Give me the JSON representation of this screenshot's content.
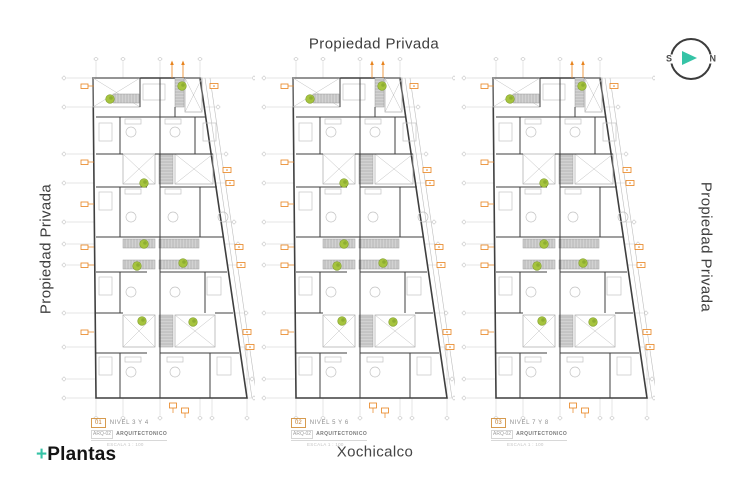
{
  "labels": {
    "top": "Propiedad Privada",
    "left": "Propiedad Privada",
    "right": "Propiedad Privada",
    "bottom_center": "Xochicalco",
    "logo_plus": "+",
    "logo_text": "Plantas"
  },
  "compass": {
    "west_label": "S",
    "east_label": "N"
  },
  "plans": [
    {
      "number": "01",
      "level_label": "NIVEL 3 Y 4",
      "sheet_code": "ARQ-02",
      "sheet_label": "ARQUITECTONICO",
      "scale_label": "ESCALA 1 : 100"
    },
    {
      "number": "02",
      "level_label": "NIVEL 5 Y 6",
      "sheet_code": "ARQ-02",
      "sheet_label": "ARQUITECTONICO",
      "scale_label": "ESCALA 1 : 100"
    },
    {
      "number": "03",
      "level_label": "NIVEL 7 Y 8",
      "sheet_code": "ARQ-02",
      "sheet_label": "ARQUITECTONICO",
      "scale_label": "ESCALA 1 : 100"
    }
  ],
  "colors": {
    "accent_teal": "#35c3a6",
    "accent_orange": "#e8831d",
    "plant_green": "#a6c43e",
    "plant_green_dark": "#7f9d2b",
    "wall": "#3f3f3f",
    "grid": "#c9c9c9",
    "light_detail": "#c3c3c3",
    "stair_fill": "#d2d2d2",
    "stair_hatch": "#8f8f8f",
    "shaft_stroke": "#a9a9a9"
  },
  "plan_geometry": {
    "view": [
      200,
      390
    ],
    "outline": [
      [
        38,
        21
      ],
      [
        145,
        21
      ],
      [
        192,
        341
      ],
      [
        41,
        341
      ]
    ],
    "diagonals": [
      [
        [
          150,
          21
        ],
        [
          197,
          341
        ]
      ],
      [
        [
          155,
          21
        ],
        [
          202,
          341
        ]
      ]
    ],
    "grid_h": [
      [
        21,
        12,
        196
      ],
      [
        50,
        12,
        160
      ],
      [
        97,
        12,
        168
      ],
      [
        126,
        12,
        172
      ],
      [
        165,
        12,
        176
      ],
      [
        187,
        12,
        180
      ],
      [
        208,
        12,
        182
      ],
      [
        256,
        12,
        188
      ],
      [
        290,
        12,
        192
      ],
      [
        322,
        12,
        194
      ],
      [
        341,
        12,
        196
      ]
    ],
    "grid_v": [
      [
        41,
        5,
        358
      ],
      [
        68,
        5,
        358
      ],
      [
        105,
        5,
        358
      ],
      [
        145,
        5,
        358
      ],
      [
        157,
        295,
        358
      ],
      [
        192,
        295,
        358
      ]
    ],
    "shafts": [
      [
        38,
        21,
        47,
        29
      ],
      [
        130,
        21,
        17,
        34
      ],
      [
        68,
        97,
        32,
        30
      ],
      [
        120,
        97,
        38,
        30
      ],
      [
        68,
        258,
        32,
        32
      ],
      [
        120,
        258,
        40,
        32
      ]
    ],
    "stairs": [
      {
        "r": [
          58,
          37,
          26,
          9
        ],
        "dir": "v"
      },
      {
        "r": [
          120,
          21,
          9,
          29
        ],
        "dir": "h"
      },
      {
        "r": [
          104,
          97,
          14,
          30
        ],
        "dir": "h"
      },
      {
        "r": [
          104,
          258,
          14,
          32
        ],
        "dir": "h"
      },
      {
        "r": [
          68,
          182,
          32,
          9
        ],
        "dir": "v"
      },
      {
        "r": [
          104,
          182,
          40,
          9
        ],
        "dir": "v"
      },
      {
        "r": [
          68,
          203,
          32,
          9
        ],
        "dir": "v"
      },
      {
        "r": [
          104,
          203,
          40,
          9
        ],
        "dir": "v"
      }
    ],
    "walls_h": [
      [
        41,
        60,
        150
      ],
      [
        41,
        97,
        68
      ],
      [
        100,
        97,
        158
      ],
      [
        41,
        130,
        92
      ],
      [
        105,
        130,
        162
      ],
      [
        41,
        180,
        105
      ],
      [
        105,
        180,
        168
      ],
      [
        41,
        215,
        92
      ],
      [
        105,
        215,
        172
      ],
      [
        41,
        256,
        68
      ],
      [
        160,
        256,
        178
      ],
      [
        41,
        296,
        92
      ],
      [
        105,
        296,
        184
      ]
    ],
    "walls_v": [
      [
        105,
        21,
        341
      ],
      [
        85,
        21,
        50
      ],
      [
        120,
        50,
        60
      ],
      [
        65,
        60,
        97
      ],
      [
        65,
        130,
        180
      ],
      [
        65,
        215,
        256
      ],
      [
        65,
        296,
        341
      ],
      [
        140,
        60,
        97
      ],
      [
        145,
        130,
        180
      ],
      [
        150,
        215,
        256
      ],
      [
        155,
        296,
        341
      ]
    ],
    "furniture_rects": [
      [
        44,
        66,
        13,
        18
      ],
      [
        44,
        135,
        13,
        18
      ],
      [
        44,
        220,
        13,
        18
      ],
      [
        44,
        300,
        13,
        18
      ],
      [
        148,
        66,
        13,
        18
      ],
      [
        152,
        220,
        14,
        18
      ],
      [
        162,
        300,
        14,
        18
      ],
      [
        70,
        62,
        16,
        5
      ],
      [
        110,
        62,
        16,
        5
      ],
      [
        70,
        132,
        16,
        5
      ],
      [
        110,
        132,
        16,
        5
      ],
      [
        70,
        300,
        16,
        5
      ],
      [
        112,
        300,
        16,
        5
      ],
      [
        88,
        27,
        22,
        16
      ]
    ],
    "furniture_circles": [
      [
        76,
        75,
        5
      ],
      [
        120,
        75,
        5
      ],
      [
        76,
        160,
        5
      ],
      [
        118,
        160,
        5
      ],
      [
        76,
        235,
        5
      ],
      [
        120,
        235,
        5
      ],
      [
        76,
        315,
        5
      ],
      [
        120,
        315,
        5
      ],
      [
        168,
        160,
        5
      ]
    ],
    "plants": [
      [
        55,
        42
      ],
      [
        127,
        29
      ],
      [
        89,
        126
      ],
      [
        89,
        187
      ],
      [
        82,
        209
      ],
      [
        128,
        206
      ],
      [
        87,
        264
      ],
      [
        138,
        265
      ]
    ],
    "marker_left_x": 26,
    "markers_left": [
      29,
      105,
      147,
      190,
      208,
      275
    ],
    "markers_right": [
      [
        155,
        29
      ],
      [
        168,
        113
      ],
      [
        171,
        126
      ],
      [
        180,
        190
      ],
      [
        182,
        208
      ],
      [
        188,
        275
      ],
      [
        191,
        290
      ]
    ],
    "markers_top": [
      117,
      128
    ],
    "markers_bottom": [
      [
        118,
        346
      ],
      [
        130,
        351
      ]
    ]
  }
}
